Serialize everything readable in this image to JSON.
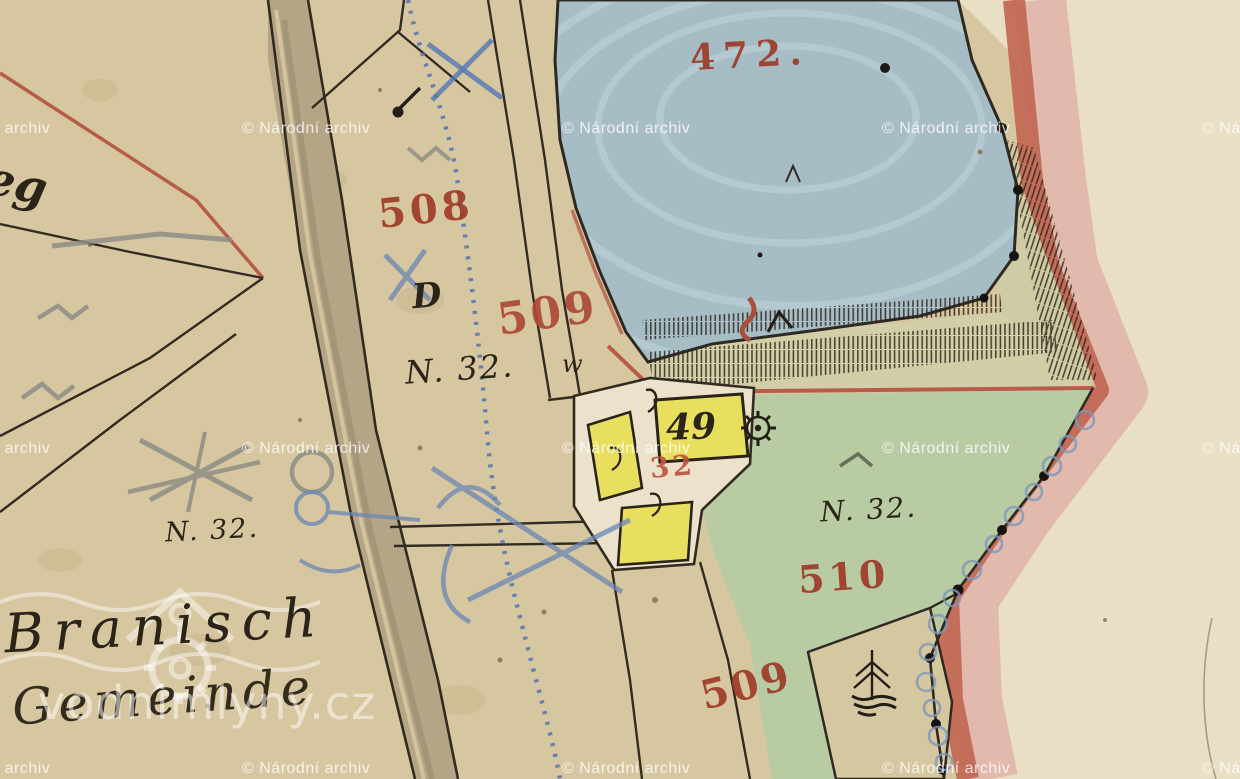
{
  "map": {
    "kind": "hand-drawn historical cadastral map sheet (watercolor on paper)",
    "labels": {
      "pond_number": "472.",
      "n508": "508",
      "n509_upper": "509",
      "n509_lower": "509",
      "n510": "510",
      "house_red_32": "32",
      "house_49": "49",
      "letter_d": "D",
      "n32_center": "N. 32.",
      "n32_left": "N. 32.",
      "n32_right": "N. 32.",
      "w_mark": "w",
      "edge_fragment": "eg",
      "village_name": "Branisch",
      "village_script": "Gemeinde"
    },
    "symbols": {
      "mill_wheel": "waterwheel-gear-icon",
      "tree": "conifer-tree-icon",
      "stream": "blue-dotted-stream",
      "dam_hachures": "slope-hachures",
      "boundary_dots": "boundary-survey-dots",
      "blue_scallops": "blue-scallop-boundary"
    },
    "colors": {
      "paper": "#d7c7a0",
      "paper_light": "#e9dfc4",
      "pond_blue": "#a7bdc6",
      "meadow_green": "#b9cba3",
      "dam_khaki": "#d2cfa8",
      "building_yellow": "#e9df5e",
      "red_ink": "#9e3a28",
      "border_red": "#c16552",
      "border_pink": "#dfb3a9",
      "black_ink": "#322b20",
      "blue_pencil": "#6b86b5",
      "road_fill": "#b3a586"
    }
  },
  "watermarks": {
    "archive_text": "© Národní archiv",
    "site_text": "vodnimlyny.cz"
  }
}
